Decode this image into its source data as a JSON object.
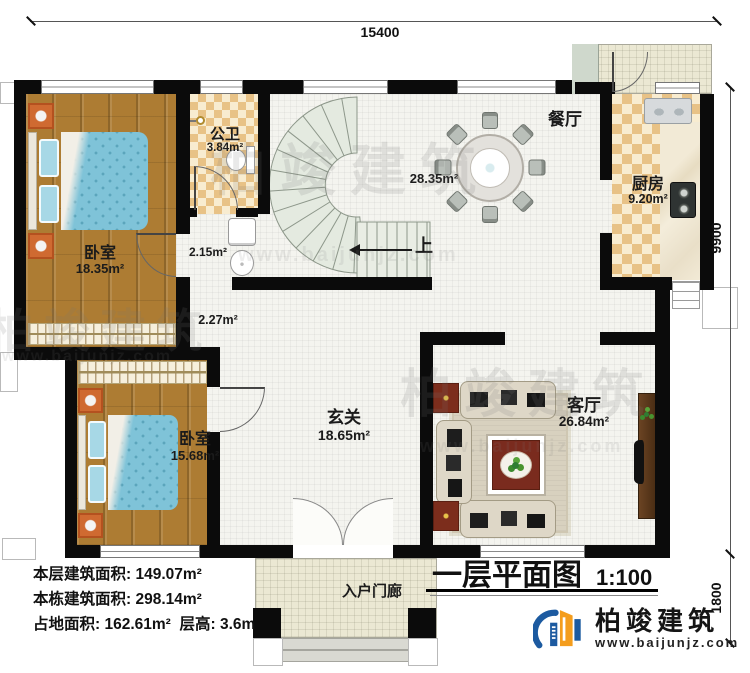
{
  "dimensions": {
    "top": "15400",
    "right_main": "9900",
    "right_porch": "1800"
  },
  "rooms": {
    "bedroom_top": {
      "label": "卧室",
      "area": "18.35m²"
    },
    "bathroom": {
      "label": "公卫",
      "area": "3.84m²"
    },
    "laundry": {
      "area": "2.15m²"
    },
    "corridor": {
      "area": "2.27m²"
    },
    "stairs": {
      "up_label": "上"
    },
    "dining": {
      "label": "餐厅",
      "area": "28.35m²"
    },
    "kitchen": {
      "label": "厨房",
      "area": "9.20m²"
    },
    "foyer": {
      "label": "玄关",
      "area": "18.65m²"
    },
    "living": {
      "label": "客厅",
      "area": "26.84m²"
    },
    "bedroom_bottom": {
      "label": "卧室",
      "area": "15.68m²"
    },
    "porch": {
      "label": "入户门廊"
    }
  },
  "title": {
    "text": "一层平面图",
    "scale": "1:100"
  },
  "stats": {
    "line1_label": "本层建筑面积:",
    "line1_value": "149.07m²",
    "line2_label": "本栋建筑面积:",
    "line2_value": "298.14m²",
    "line3_label": "占地面积:",
    "line3_value": "162.61m²",
    "line3b_label": "层高:",
    "line3b_value": "3.6m"
  },
  "brand": {
    "name": "柏竣建筑",
    "url": "www.baijunjz.com"
  },
  "colors": {
    "brand_blue": "#1c5aa0",
    "brand_orange": "#f49d1d",
    "wall": "#0b0b0b"
  }
}
